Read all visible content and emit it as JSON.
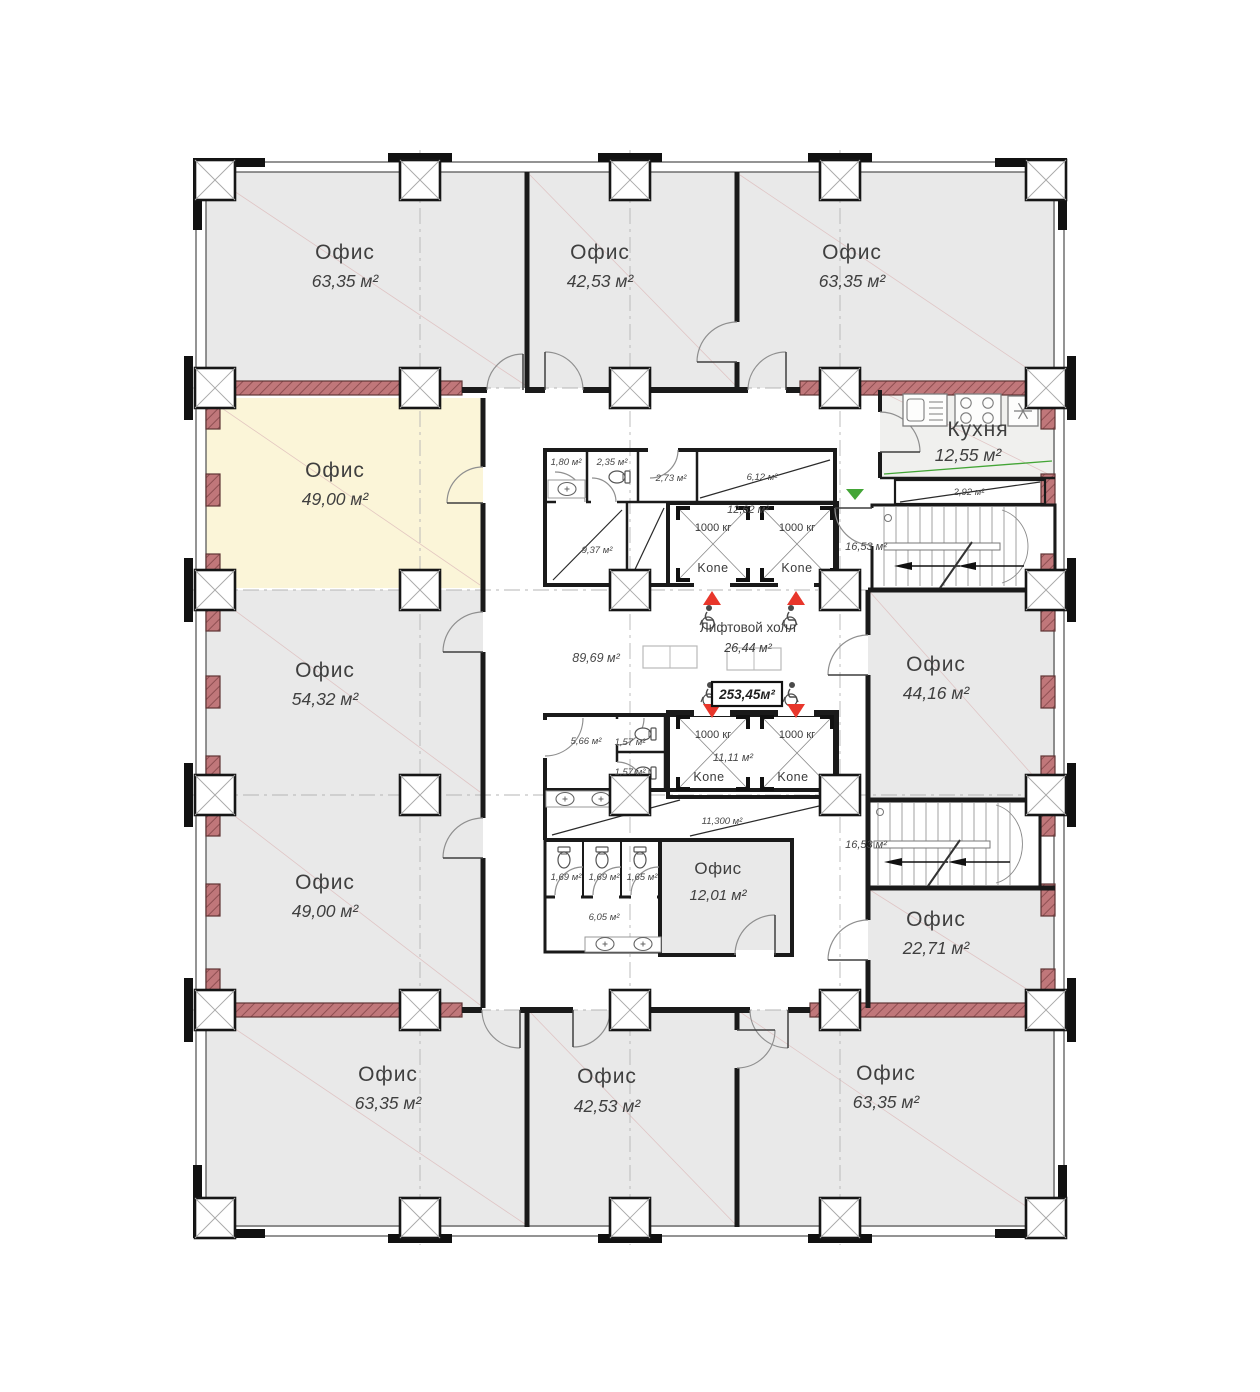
{
  "offices": [
    {
      "name": "Офис",
      "area": "63,35 м²"
    },
    {
      "name": "Офис",
      "area": "42,53 м²"
    },
    {
      "name": "Офис",
      "area": "63,35 м²"
    },
    {
      "name": "Офис",
      "area": "49,00 м²",
      "highlighted": true
    },
    {
      "name": "Офис",
      "area": "54,32 м²"
    },
    {
      "name": "Офис",
      "area": "49,00 м²"
    },
    {
      "name": "Офис",
      "area": "63,35 м²"
    },
    {
      "name": "Офис",
      "area": "42,53 м²"
    },
    {
      "name": "Офис",
      "area": "63,35 м²"
    },
    {
      "name": "Офис",
      "area": "44,16 м²"
    },
    {
      "name": "Офис",
      "area": "22,71 м²"
    },
    {
      "name": "Офис",
      "area": "12,01 м²"
    }
  ],
  "kitchen": {
    "name": "Кухня",
    "area": "12,55 м²"
  },
  "lift_hall": {
    "name": "Лифтовой холл",
    "area": "26,44 м²"
  },
  "total_area": "253,45м²",
  "corridors": {
    "main_area": "89,69 м²",
    "service_area": "11,300 м²"
  },
  "stairs": {
    "upper_area": "16,53 м²",
    "lower_area": "16,53 м²"
  },
  "elevators": {
    "brand": "Kone",
    "capacity": "1000 кг",
    "upper_shaft_area": "12,62 м²",
    "lower_shaft_area": "11,11 м²"
  },
  "service_rooms": {
    "r180": "1,80 м²",
    "r235": "2,35 м²",
    "r273": "2,73 м²",
    "r612": "6,12 м²",
    "r937": "9,37 м²",
    "r292": "2,92 м²",
    "r566": "5,66 м²",
    "r157a": "1,57 м²",
    "r157b": "1,57 м²",
    "r169a": "1,69 м²",
    "r169b": "1,69 м²",
    "r165": "1,65 м²",
    "r605": "6,05 м²"
  },
  "colors": {
    "office_fill": "#e9e9e9",
    "highlight_fill": "#fbf5d8",
    "load_wall": "#c0777a",
    "marker_red": "#e8362b",
    "marker_green": "#43a536"
  }
}
